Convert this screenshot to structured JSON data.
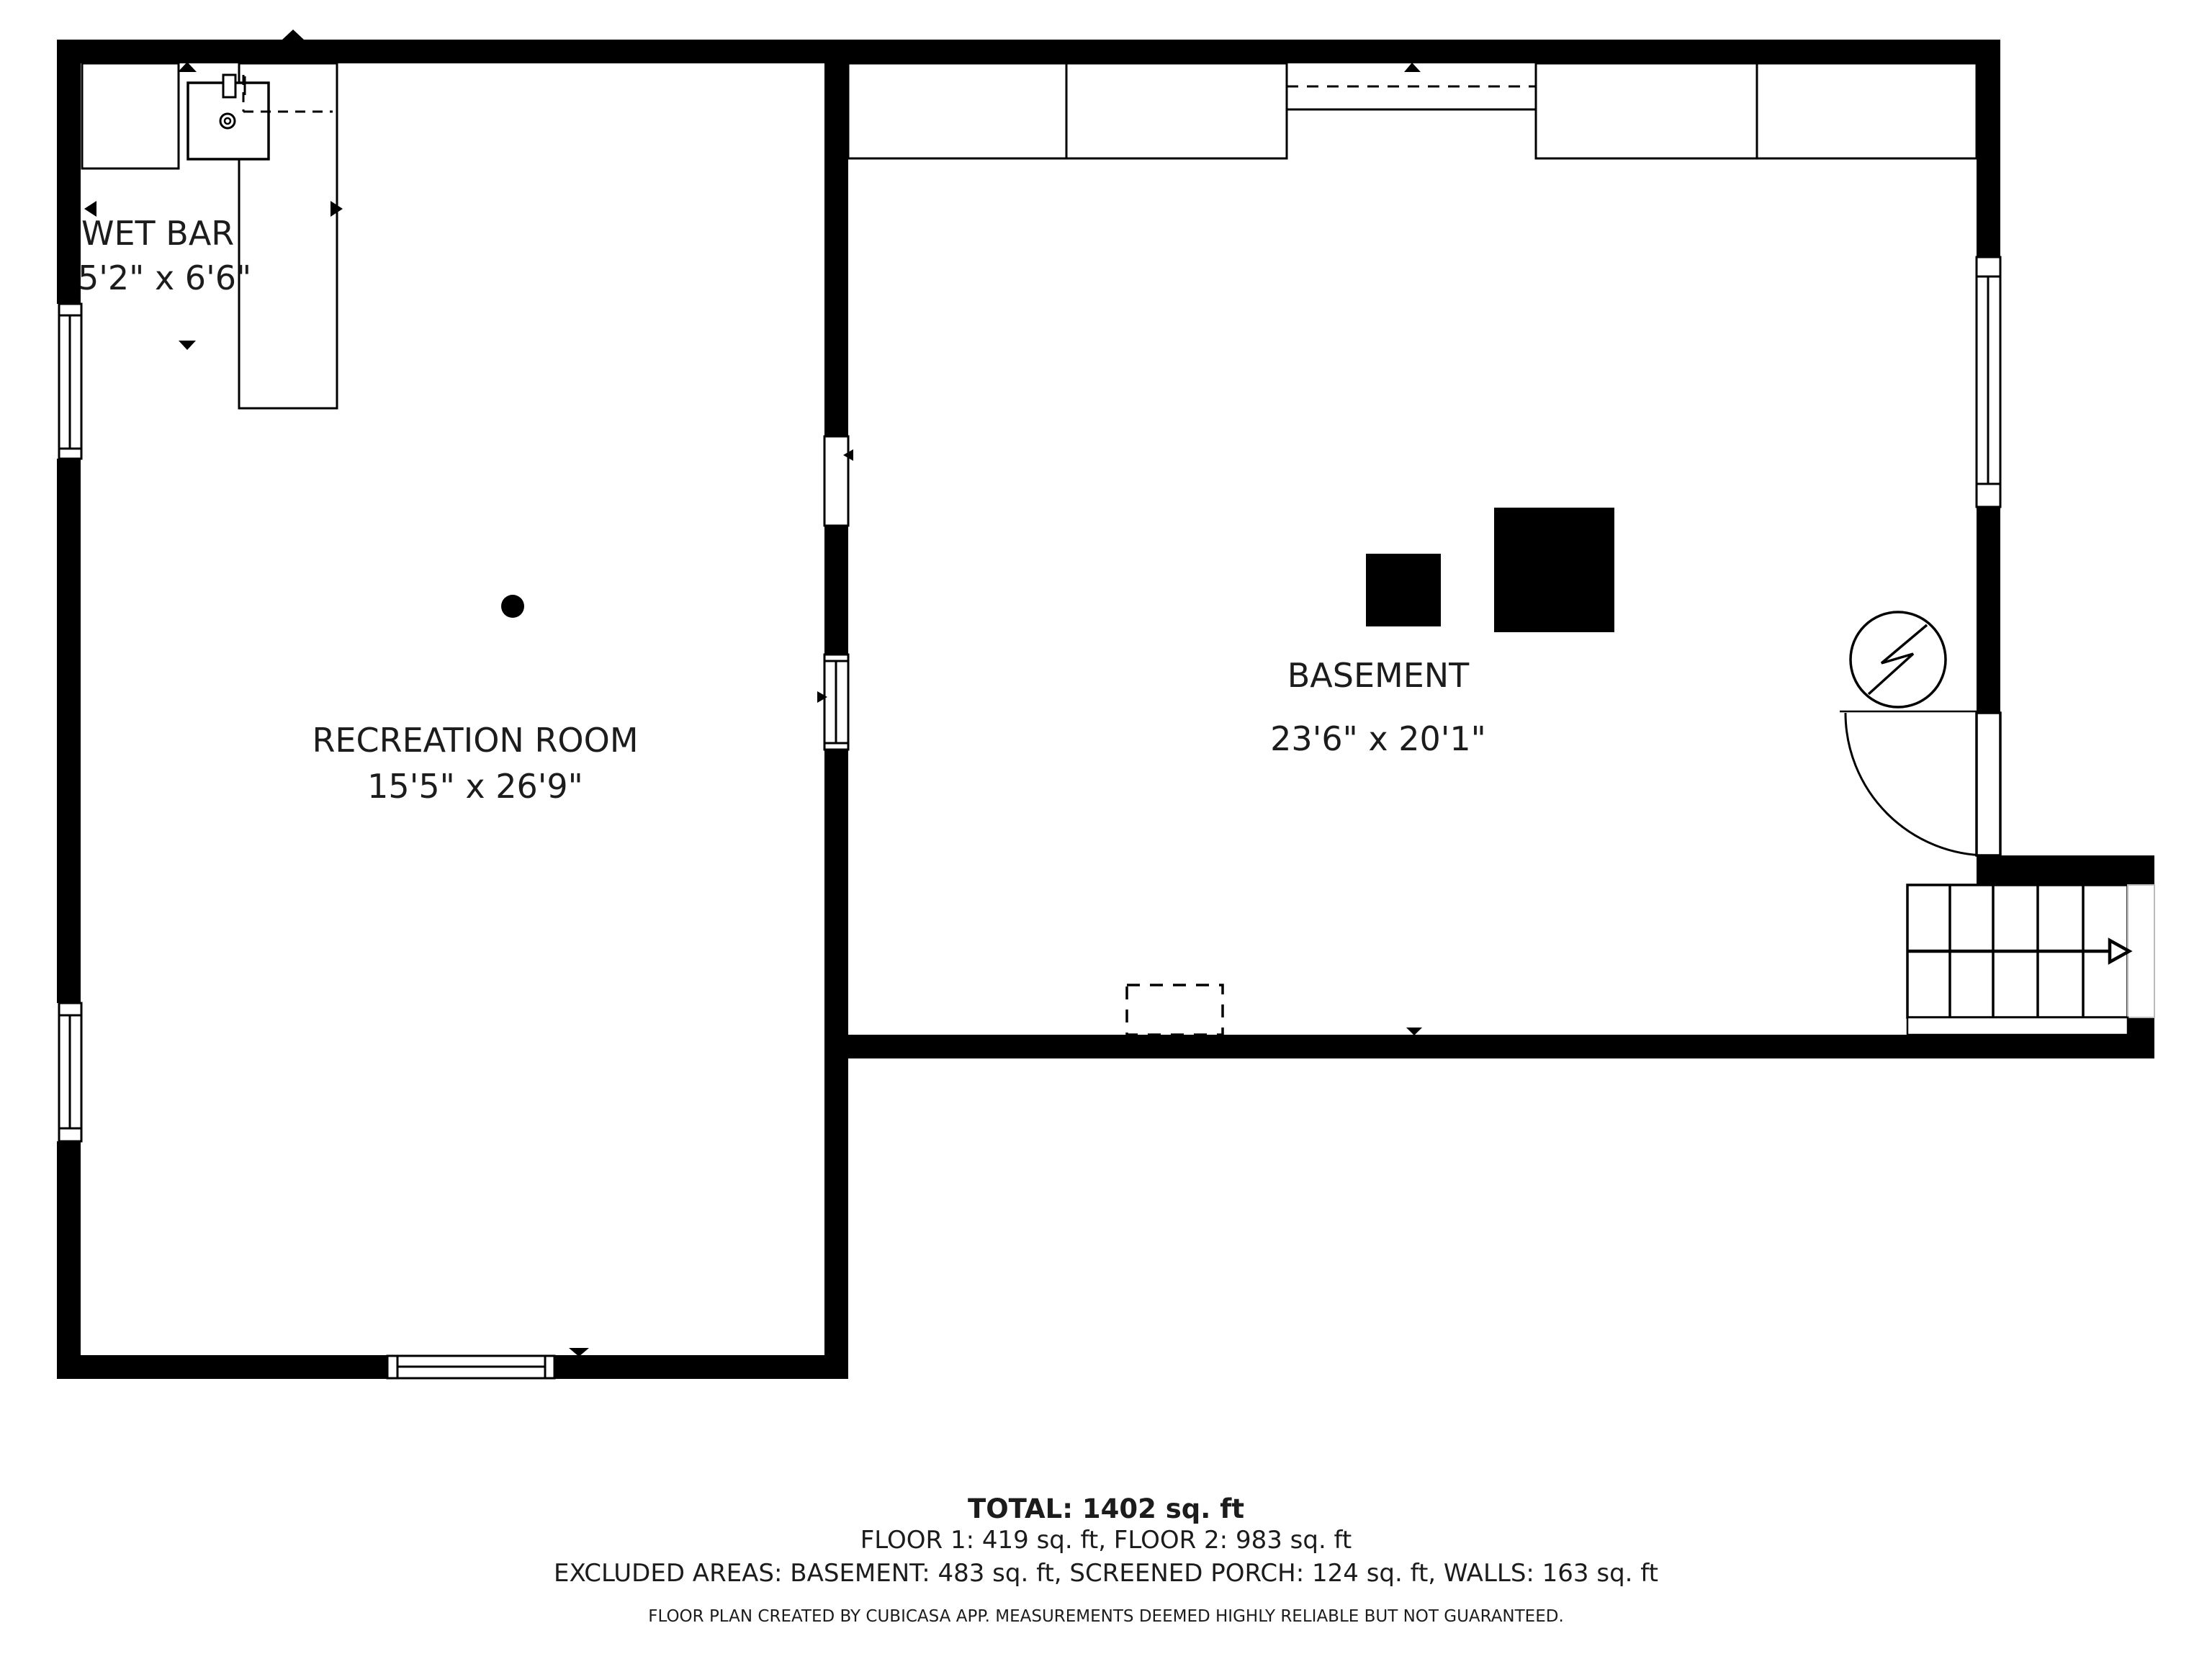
{
  "title": "Basement floor plan",
  "colors": {
    "wall": "#000000",
    "background": "#ffffff",
    "text": "#1c1c1c"
  },
  "rooms": [
    {
      "id": "wet-bar",
      "label": "WET BAR",
      "dimensions": "5'2\" x 6'6\""
    },
    {
      "id": "recreation-room",
      "label": "RECREATION ROOM",
      "dimensions": "15'5\" x 26'9\""
    },
    {
      "id": "basement",
      "label": "BASEMENT",
      "dimensions": "23'6\" x 20'1\""
    }
  ],
  "summary": {
    "total": "TOTAL: 1402 sq. ft",
    "floors": "FLOOR 1: 419 sq. ft, FLOOR 2: 983 sq. ft",
    "excluded": "EXCLUDED AREAS: BASEMENT: 483 sq. ft, SCREENED PORCH: 124 sq. ft, WALLS: 163 sq. ft",
    "disclaimer": "FLOOR PLAN CREATED BY CUBICASA APP. MEASUREMENTS DEEMED HIGHLY RELIABLE BUT NOT GUARANTEED."
  },
  "icons": {
    "sink": "sink-icon",
    "electrical": "electrical-meter-icon",
    "stairs": "stairs-up-icon",
    "dot": "ceiling-point-icon"
  }
}
